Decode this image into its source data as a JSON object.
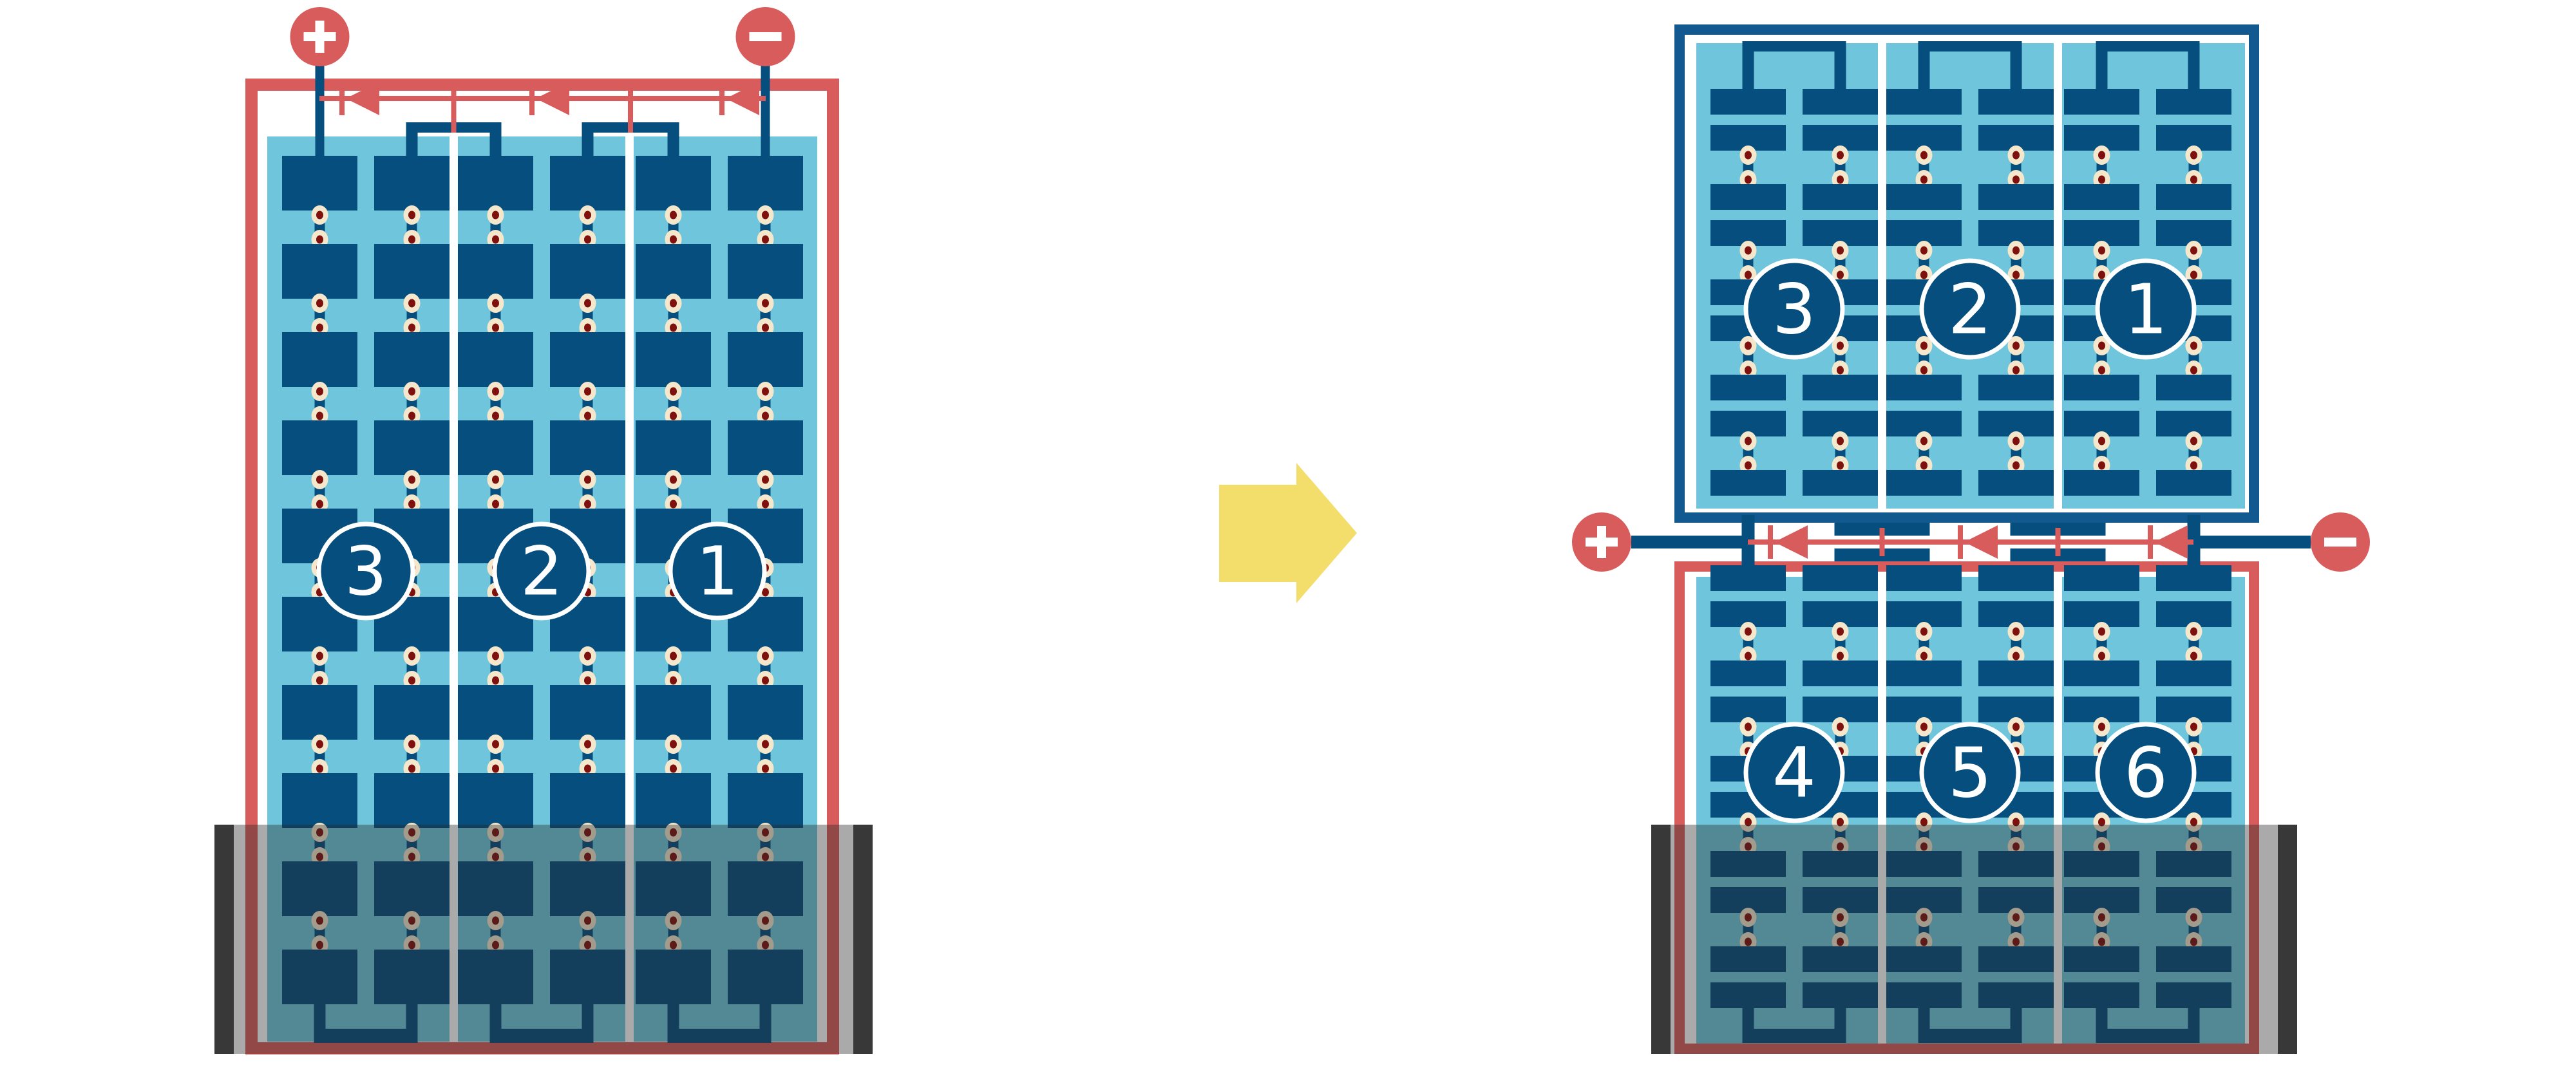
{
  "diagram": {
    "colors": {
      "frame_red": "#D95C5C",
      "frame_blue": "#12598F",
      "cell_dark_blue": "#054E7D",
      "panel_light_blue": "#6FC6DC",
      "divider_white": "#FFFFFF",
      "solder_dot_cream": "#F4E7CC",
      "solder_dot_red": "#7E100D",
      "arrow_yellow": "#F4DE6B",
      "shadow_overlay": "rgba(42,42,42,0.40)",
      "shadow_post_black": "#383838",
      "number_text_white": "#FFFFFF"
    },
    "left_panel": {
      "strings": 3,
      "rows": 10,
      "string_labels": [
        "3",
        "2",
        "1"
      ],
      "terminals": {
        "plus": "+",
        "minus": "−"
      },
      "bypass_diode_count": 3,
      "shaded": true
    },
    "arrow": {
      "direction": "right"
    },
    "right_top_panel": {
      "strings": 3,
      "rows": 9,
      "string_labels": [
        "3",
        "2",
        "1"
      ],
      "shaded": false
    },
    "right_bottom_panel": {
      "strings": 3,
      "rows": 10,
      "string_labels": [
        "4",
        "5",
        "6"
      ],
      "shaded": true
    },
    "junction": {
      "terminals": {
        "plus": "+",
        "minus": "−"
      },
      "bypass_diode_count": 3
    }
  }
}
